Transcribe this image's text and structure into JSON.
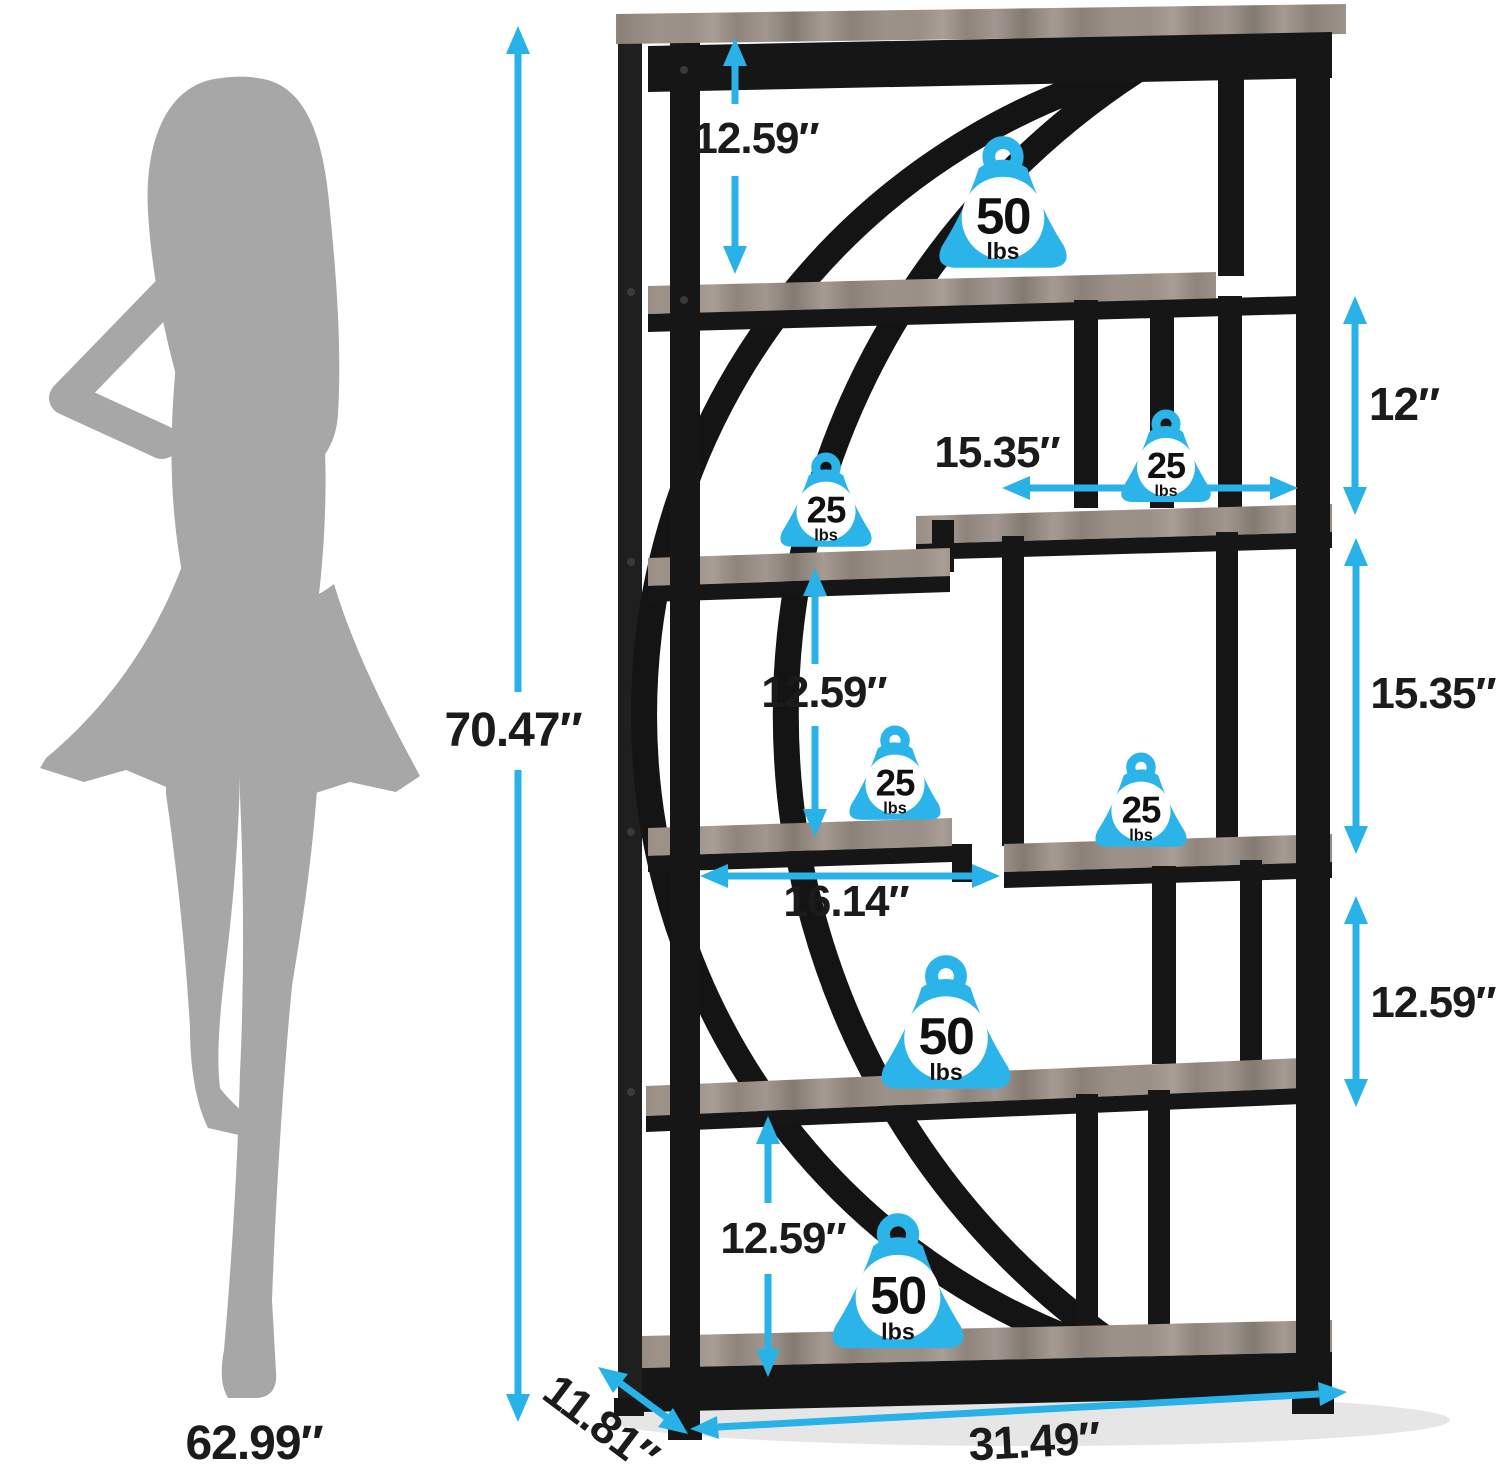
{
  "diagram": {
    "kind": "furniture-dimension-diagram",
    "subject": "8-tier staggered etagere bookshelf with crescent arc frame",
    "dimensions_summary": {
      "overall_height": "70.47″",
      "overall_width": "31.49″",
      "overall_depth": "11.81″",
      "person_height": "62.99″",
      "shelf_gaps": [
        "12.59″",
        "12″",
        "12.59″",
        "12.59″",
        "12.59″"
      ],
      "compartment_sizes": [
        "15.35″",
        "15.35″",
        "16.14″"
      ],
      "shelf_capacities": [
        "50 lbs",
        "25 lbs",
        "25 lbs",
        "25 lbs",
        "25 lbs",
        "50 lbs",
        "50 lbs"
      ]
    }
  },
  "colors": {
    "accent_arrow": "#29b2e8",
    "badge_fill": "#2bb4ea",
    "frame_black": "#161616",
    "wood_gray": "#99908a",
    "silhouette_gray": "#a7a7a7",
    "label_text": "#1b1b1b"
  },
  "annotations": {
    "dimension_labels": [
      {
        "name": "dim-overall-height",
        "text": "70.47″",
        "x": 513,
        "y": 731,
        "font_px": 48
      },
      {
        "name": "dim-top-shelf-gap",
        "text": "12.59″",
        "x": 756,
        "y": 139,
        "font_px": 44
      },
      {
        "name": "dim-right-upper-gap",
        "text": "12″",
        "x": 1404,
        "y": 404,
        "font_px": 46
      },
      {
        "name": "dim-upper-shelf-width",
        "text": "15.35″",
        "x": 997,
        "y": 453,
        "font_px": 44
      },
      {
        "name": "dim-middle-shelf-gap",
        "text": "12.59″",
        "x": 824,
        "y": 693,
        "font_px": 44
      },
      {
        "name": "dim-cubby-height",
        "text": "15.35″",
        "x": 1433,
        "y": 694,
        "font_px": 44
      },
      {
        "name": "dim-lower-shelf-width",
        "text": "16.14″",
        "x": 846,
        "y": 902,
        "font_px": 44
      },
      {
        "name": "dim-right-lower-gap",
        "text": "12.59″",
        "x": 1433,
        "y": 1003,
        "font_px": 44
      },
      {
        "name": "dim-bottom-shelf-gap",
        "text": "12.59″",
        "x": 783,
        "y": 1239,
        "font_px": 44
      },
      {
        "name": "dim-overall-width",
        "text": "31.49″",
        "x": 1034,
        "y": 1441,
        "font_px": 46,
        "rotate_deg": -3
      },
      {
        "name": "dim-overall-depth",
        "text": "11.81″",
        "x": 601,
        "y": 1423,
        "font_px": 46,
        "rotate_deg": 37
      },
      {
        "name": "dim-person-height",
        "text": "62.99″",
        "x": 254,
        "y": 1444,
        "font_px": 48
      }
    ],
    "weight_badges": [
      {
        "name": "badge-top-shelf-50lbs",
        "value": "50",
        "unit": "lbs",
        "x": 930,
        "y": 134,
        "w": 146,
        "h": 148
      },
      {
        "name": "badge-upper-right-25lbs",
        "value": "25",
        "unit": "lbs",
        "x": 1111,
        "y": 408,
        "w": 110,
        "h": 104
      },
      {
        "name": "badge-middle-left-25lbs",
        "value": "25",
        "unit": "lbs",
        "x": 773,
        "y": 451,
        "w": 106,
        "h": 106
      },
      {
        "name": "badge-lower-left-25lbs",
        "value": "25",
        "unit": "lbs",
        "x": 842,
        "y": 724,
        "w": 106,
        "h": 106
      },
      {
        "name": "badge-cubby-25lbs",
        "value": "25",
        "unit": "lbs",
        "x": 1088,
        "y": 751,
        "w": 106,
        "h": 106
      },
      {
        "name": "badge-fifth-shelf-50lbs",
        "value": "50",
        "unit": "lbs",
        "x": 871,
        "y": 953,
        "w": 150,
        "h": 150
      },
      {
        "name": "badge-bottom-shelf-50lbs",
        "value": "50",
        "unit": "lbs",
        "x": 822,
        "y": 1211,
        "w": 152,
        "h": 152
      }
    ]
  }
}
